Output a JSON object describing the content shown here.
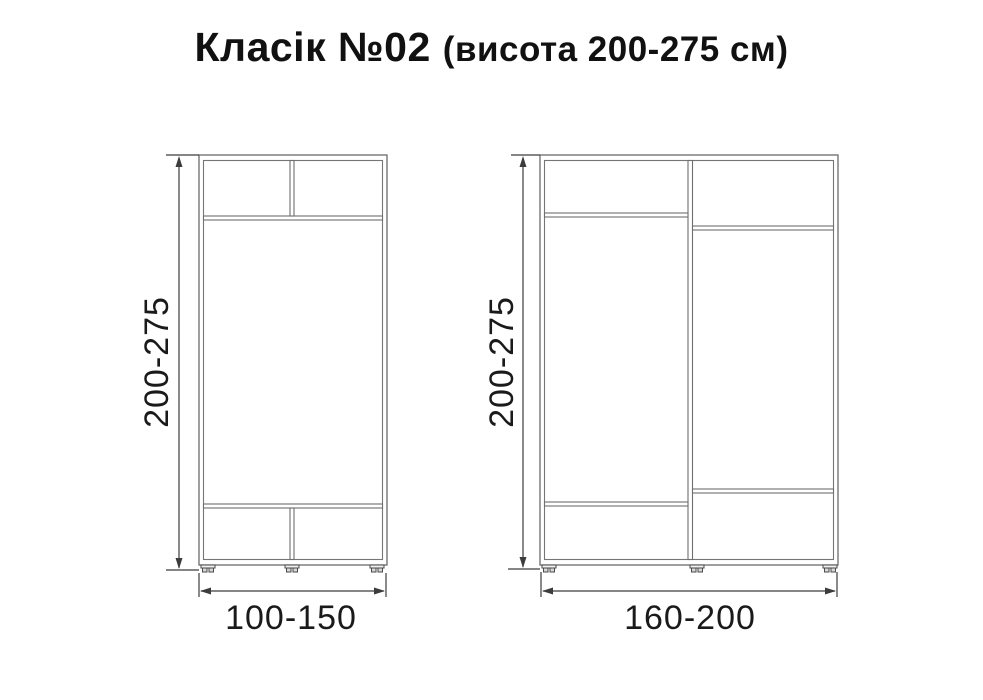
{
  "title": {
    "model": "Класік №02",
    "height_note": "(висота 200-275 см)"
  },
  "diagrams": [
    {
      "name": "wardrobe-small",
      "height_label": "200-275",
      "width_label": "100-150",
      "sections": "two top compartments, open middle, two bottom compartments"
    },
    {
      "name": "wardrobe-large",
      "height_label": "200-275",
      "width_label": "160-200",
      "sections": "two vertical halves with offset top and bottom shelves"
    }
  ],
  "colors": {
    "background": "#ffffff",
    "cabinet_line": "#6b6b6b",
    "dimension_line": "#3c3c3c",
    "text": "#111111"
  }
}
